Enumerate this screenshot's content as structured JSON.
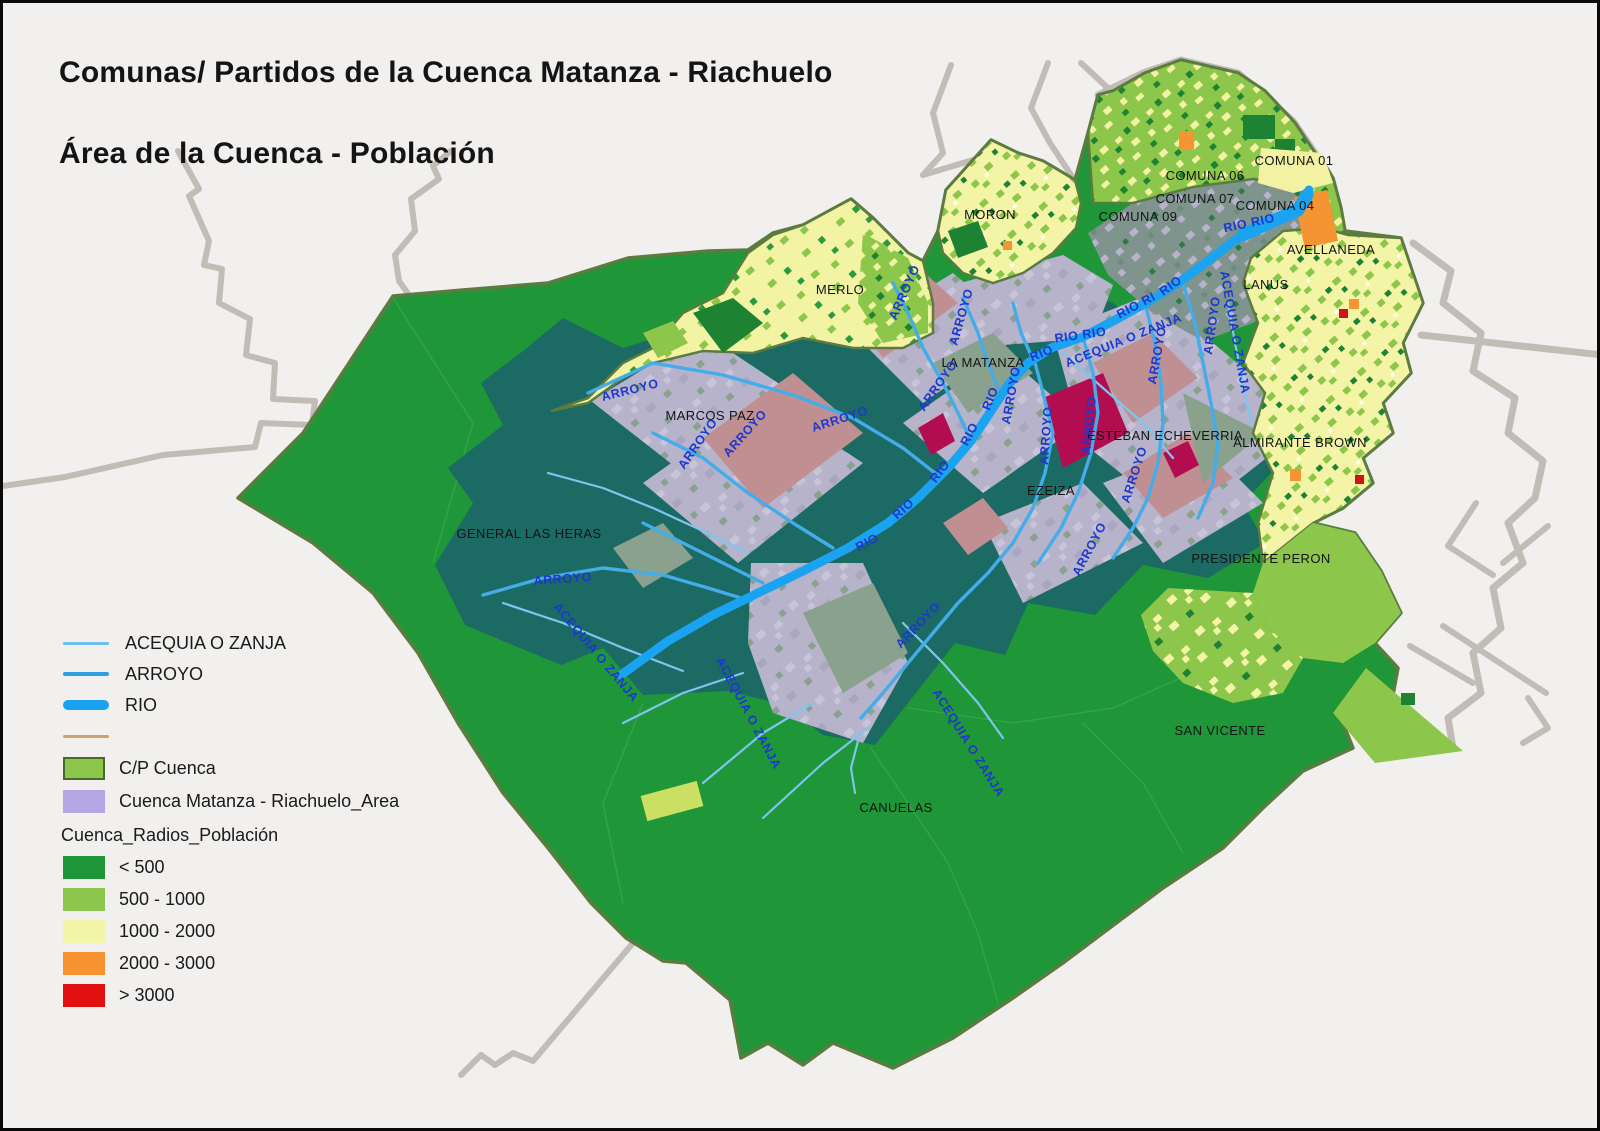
{
  "title": {
    "line1": "Comunas/ Partidos de la Cuenca Matanza - Riachuelo",
    "line2": "Área de la Cuenca - Población"
  },
  "legend": {
    "lines": [
      {
        "label": "ACEQUIA O ZANJA",
        "color": "#6fbde9"
      },
      {
        "label": "ARROYO",
        "color": "#2d9fe0"
      },
      {
        "label": "RIO",
        "color": "#18a2f0"
      },
      {
        "label": "",
        "color": "#c9a56f"
      }
    ],
    "areas": [
      {
        "label": "C/P Cuenca",
        "color": "#8cc64b"
      },
      {
        "label": "Cuenca Matanza - Riachuelo_Area",
        "color": "#b4a7e4"
      }
    ],
    "population": {
      "header": "Cuenca_Radios_Población",
      "classes": [
        {
          "label": "< 500",
          "color": "#1e9539"
        },
        {
          "label": "500 - 1000",
          "color": "#8dc64c"
        },
        {
          "label": "1000 - 2000",
          "color": "#f4f5a6"
        },
        {
          "label": "2000 - 3000",
          "color": "#f59331"
        },
        {
          "label": "> 3000",
          "color": "#e11111"
        }
      ]
    }
  },
  "map": {
    "region_labels": [
      {
        "text": "MERLO",
        "x": 837,
        "y": 291
      },
      {
        "text": "MORON",
        "x": 987,
        "y": 216
      },
      {
        "text": "COMUNA 09",
        "x": 1135,
        "y": 218
      },
      {
        "text": "COMUNA 07",
        "x": 1192,
        "y": 200
      },
      {
        "text": "COMUNA 06",
        "x": 1202,
        "y": 177
      },
      {
        "text": "COMUNA 04",
        "x": 1272,
        "y": 207
      },
      {
        "text": "COMUNA 01",
        "x": 1291,
        "y": 162
      },
      {
        "text": "AVELLANEDA",
        "x": 1328,
        "y": 251
      },
      {
        "text": "LANUS",
        "x": 1263,
        "y": 286
      },
      {
        "text": "LA MATANZA",
        "x": 980,
        "y": 364
      },
      {
        "text": "MARCOS PAZ",
        "x": 707,
        "y": 417
      },
      {
        "text": "GENERAL LAS HERAS",
        "x": 526,
        "y": 535
      },
      {
        "text": "ESTEBAN ECHEVERRIA",
        "x": 1162,
        "y": 437
      },
      {
        "text": "EZEIZA",
        "x": 1048,
        "y": 492
      },
      {
        "text": "ALMIRANTE BROWN",
        "x": 1297,
        "y": 444
      },
      {
        "text": "PRESIDENTE PERON",
        "x": 1258,
        "y": 560
      },
      {
        "text": "SAN VICENTE",
        "x": 1217,
        "y": 732
      },
      {
        "text": "CANUELAS",
        "x": 893,
        "y": 809
      }
    ],
    "river_labels": [
      {
        "text": "RIO",
        "x": 866,
        "y": 543,
        "r": -28
      },
      {
        "text": "RIO",
        "x": 903,
        "y": 509,
        "r": -42
      },
      {
        "text": "RIO",
        "x": 940,
        "y": 471,
        "r": -52
      },
      {
        "text": "RIO",
        "x": 970,
        "y": 433,
        "r": -62
      },
      {
        "text": "RIO",
        "x": 991,
        "y": 397,
        "r": -68
      },
      {
        "text": "RIO",
        "x": 1040,
        "y": 354,
        "r": -22
      },
      {
        "text": "RIO RIO",
        "x": 1078,
        "y": 336,
        "r": -8
      },
      {
        "text": "RIO RI",
        "x": 1135,
        "y": 306,
        "r": -28
      },
      {
        "text": "RIO",
        "x": 1170,
        "y": 286,
        "r": -36
      },
      {
        "text": "RIO RIO",
        "x": 1247,
        "y": 224,
        "r": -12
      },
      {
        "text": "ARROYO",
        "x": 628,
        "y": 391,
        "r": -14
      },
      {
        "text": "ARROYO",
        "x": 838,
        "y": 420,
        "r": -18
      },
      {
        "text": "ARROYO",
        "x": 745,
        "y": 433,
        "r": -48
      },
      {
        "text": "ARROYO",
        "x": 698,
        "y": 443,
        "r": -55
      },
      {
        "text": "ARROYO",
        "x": 905,
        "y": 291,
        "r": -66
      },
      {
        "text": "ARROYO",
        "x": 962,
        "y": 315,
        "r": -74
      },
      {
        "text": "ARROYO",
        "x": 1012,
        "y": 393,
        "r": -80
      },
      {
        "text": "ARROYO",
        "x": 938,
        "y": 385,
        "r": -55
      },
      {
        "text": "ARROYO",
        "x": 1047,
        "y": 433,
        "r": -86
      },
      {
        "text": "ARROYO",
        "x": 1090,
        "y": 423,
        "r": -84
      },
      {
        "text": "ARROYO",
        "x": 1213,
        "y": 323,
        "r": -82
      },
      {
        "text": "ARROYO",
        "x": 1158,
        "y": 353,
        "r": -80
      },
      {
        "text": "ARROYO",
        "x": 1135,
        "y": 473,
        "r": -72
      },
      {
        "text": "ARROYO",
        "x": 1090,
        "y": 548,
        "r": -62
      },
      {
        "text": "ARROYO",
        "x": 918,
        "y": 625,
        "r": -46
      },
      {
        "text": "ARROYO",
        "x": 560,
        "y": 580,
        "r": -4
      },
      {
        "text": "ACEQUIA O ZANJA",
        "x": 1122,
        "y": 341,
        "r": -22
      },
      {
        "text": "ACEQUIA O ZANJA",
        "x": 1228,
        "y": 330,
        "r": 80
      },
      {
        "text": "ACEQUIA O ZANJA",
        "x": 742,
        "y": 712,
        "r": 62
      },
      {
        "text": "ACEQUIA O ZANJA",
        "x": 962,
        "y": 742,
        "r": 58
      },
      {
        "text": "ACEQUIA O ZANJA",
        "x": 590,
        "y": 652,
        "r": 50
      }
    ]
  }
}
